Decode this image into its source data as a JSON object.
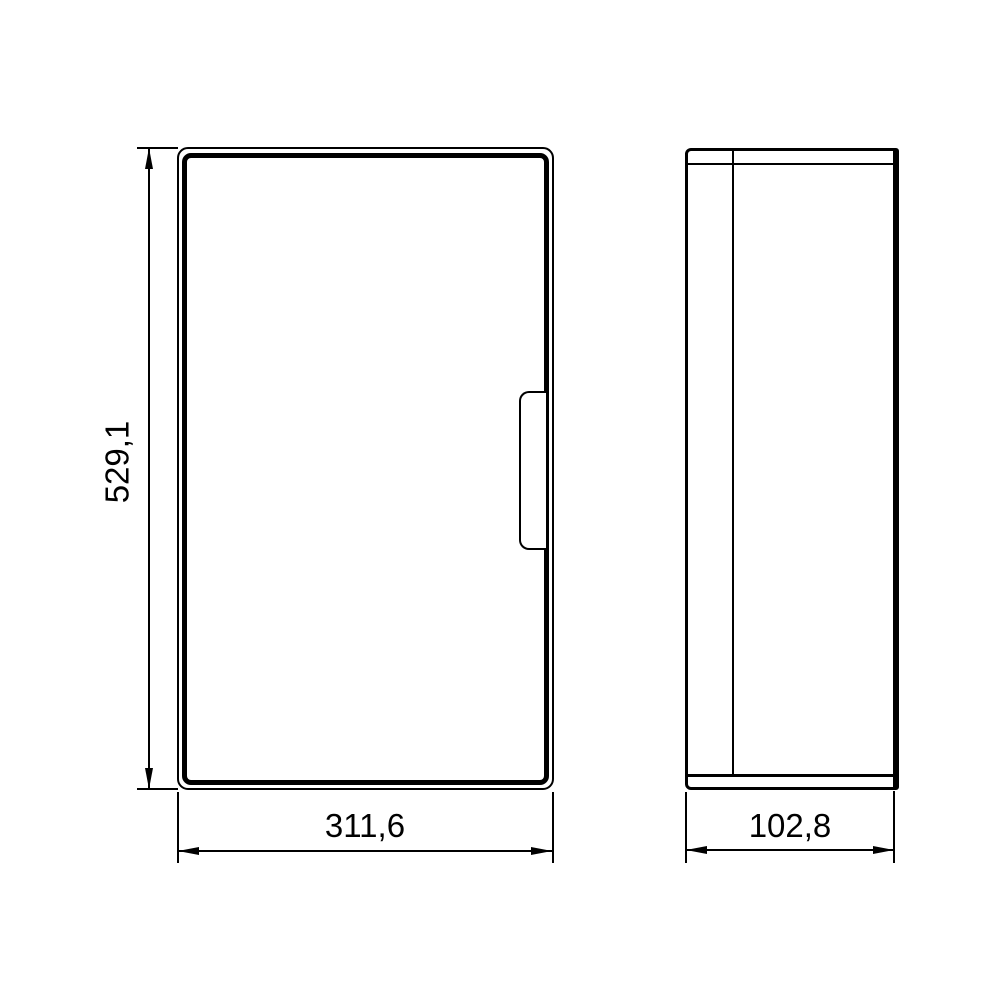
{
  "drawing": {
    "background_color": "#ffffff",
    "line_color": "#000000",
    "views": {
      "front": {
        "description": "front view of enclosure with door and handle"
      },
      "side": {
        "description": "side view of enclosure with door seam and flange lines"
      }
    },
    "dimensions": {
      "height": {
        "label": "529,1"
      },
      "width": {
        "label": "311,6"
      },
      "depth": {
        "label": "102,8"
      }
    }
  }
}
